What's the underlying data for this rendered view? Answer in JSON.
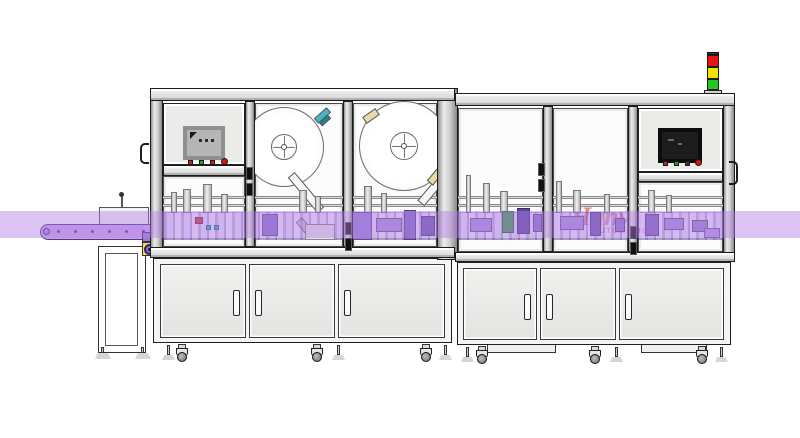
{
  "meta": {
    "width": 800,
    "height": 438,
    "description": "CAD side view of an automatic labeling machine line with infeed conveyor, two enclosed machine frames, two label reels, HMI panels, stack light and base cabinets",
    "background": "#ffffff"
  },
  "band": {
    "y": 211,
    "height": 27,
    "color": "rgba(178,126,232,0.45)"
  },
  "watermark": {
    "parts": [
      {
        "text": "H",
        "color": "#c8281e"
      },
      {
        "text": "a",
        "color": "#f08c1e"
      },
      {
        "text": "nvi",
        "color": "#c8281e"
      }
    ],
    "sub": "AUTOMATION",
    "sub_color": "#c8281e"
  },
  "signal_tower": {
    "base": {
      "x": 704,
      "y": 90,
      "w": 18,
      "h": 5
    },
    "cap": {
      "x": 707,
      "y": 52,
      "w": 12,
      "h": 3
    },
    "segments": [
      {
        "name": "red-light",
        "color": "#e81414",
        "x": 707,
        "y": 55,
        "w": 12,
        "h": 12
      },
      {
        "name": "yellow-light",
        "color": "#f2e400",
        "x": 707,
        "y": 67,
        "w": 12,
        "h": 12
      },
      {
        "name": "green-light",
        "color": "#22c822",
        "x": 707,
        "y": 79,
        "w": 12,
        "h": 11
      }
    ]
  },
  "hmi": {
    "left": {
      "panel": {
        "x": 163,
        "y": 103,
        "w": 82,
        "h": 62
      },
      "screen": {
        "x": 185,
        "y": 128,
        "w": 38,
        "h": 30,
        "bezel": "#8f8f8f",
        "face": "#b5b5b5"
      },
      "buttons": [
        {
          "x": 188,
          "y": 160,
          "shape": "square",
          "color": "#c32420"
        },
        {
          "x": 199,
          "y": 160,
          "shape": "square",
          "color": "#1ea31e"
        },
        {
          "x": 210,
          "y": 160,
          "shape": "square",
          "color": "#c32420"
        },
        {
          "x": 221,
          "y": 158,
          "shape": "round",
          "color": "#e01212"
        }
      ]
    },
    "right": {
      "panel": {
        "x": 638,
        "y": 108,
        "w": 85,
        "h": 64
      },
      "screen": {
        "x": 660,
        "y": 130,
        "w": 40,
        "h": 31,
        "bezel": "#0d0d0d",
        "face": "#1d1d1d"
      },
      "buttons": [
        {
          "x": 663,
          "y": 161,
          "shape": "square",
          "color": "#c32420"
        },
        {
          "x": 674,
          "y": 161,
          "shape": "square",
          "color": "#1ea31e"
        },
        {
          "x": 685,
          "y": 161,
          "shape": "square",
          "color": "#5a2a2a"
        },
        {
          "x": 695,
          "y": 159,
          "shape": "round",
          "color": "#e01212"
        }
      ]
    }
  },
  "frame": {
    "posts": [
      {
        "x": 150,
        "y": 88,
        "w": 13,
        "h": 170
      },
      {
        "x": 245,
        "y": 101,
        "w": 10,
        "h": 146
      },
      {
        "x": 343,
        "y": 101,
        "w": 10,
        "h": 146
      },
      {
        "x": 437,
        "y": 88,
        "w": 21,
        "h": 172
      },
      {
        "x": 543,
        "y": 106,
        "w": 10,
        "h": 146
      },
      {
        "x": 628,
        "y": 106,
        "w": 10,
        "h": 146
      },
      {
        "x": 723,
        "y": 93,
        "w": 12,
        "h": 169
      }
    ],
    "beams": [
      {
        "x": 150,
        "y": 88,
        "w": 305,
        "h": 13
      },
      {
        "x": 455,
        "y": 93,
        "w": 280,
        "h": 13
      },
      {
        "x": 163,
        "y": 165,
        "w": 82,
        "h": 11
      },
      {
        "x": 638,
        "y": 172,
        "w": 85,
        "h": 10
      },
      {
        "x": 150,
        "y": 247,
        "w": 305,
        "h": 11
      },
      {
        "x": 455,
        "y": 252,
        "w": 280,
        "h": 10
      }
    ],
    "rails": [
      {
        "x": 163,
        "y": 196,
        "w": 274,
        "h": 3
      },
      {
        "x": 458,
        "y": 196,
        "w": 265,
        "h": 3
      },
      {
        "x": 163,
        "y": 204,
        "w": 274,
        "h": 3
      },
      {
        "x": 458,
        "y": 204,
        "w": 265,
        "h": 3
      }
    ],
    "hinges": [
      {
        "x": 246,
        "y": 167
      },
      {
        "x": 345,
        "y": 222
      },
      {
        "x": 538,
        "y": 163
      },
      {
        "x": 630,
        "y": 226
      }
    ]
  },
  "glass_panels": [
    {
      "x": 163,
      "y": 176,
      "w": 82,
      "h": 71
    },
    {
      "x": 255,
      "y": 103,
      "w": 88,
      "h": 144
    },
    {
      "x": 353,
      "y": 103,
      "w": 84,
      "h": 144
    },
    {
      "x": 458,
      "y": 108,
      "w": 85,
      "h": 144
    },
    {
      "x": 553,
      "y": 108,
      "w": 75,
      "h": 144
    },
    {
      "x": 638,
      "y": 182,
      "w": 85,
      "h": 70
    }
  ],
  "reels": [
    {
      "cx": 284,
      "cy": 147,
      "r": 40,
      "hub_r": 13
    },
    {
      "cx": 404,
      "cy": 146,
      "r": 45,
      "hub_r": 14
    }
  ],
  "diagonals": [
    {
      "x": 283,
      "y": 188,
      "w": 46,
      "h": 9,
      "rot": 50,
      "color": "#f6f6f6"
    },
    {
      "x": 296,
      "y": 222,
      "w": 16,
      "h": 8,
      "rot": 50,
      "color": "#e8d9a8"
    },
    {
      "x": 314,
      "y": 112,
      "w": 17,
      "h": 7,
      "rot": -42,
      "color": "#47b4c8"
    },
    {
      "x": 319,
      "y": 118,
      "w": 12,
      "h": 5,
      "rot": -42,
      "color": "#2a7f95"
    },
    {
      "x": 363,
      "y": 112,
      "w": 16,
      "h": 8,
      "rot": -35,
      "color": "#e8d9a8"
    },
    {
      "x": 413,
      "y": 182,
      "w": 44,
      "h": 9,
      "rot": -50,
      "color": "#f6f6f6"
    },
    {
      "x": 427,
      "y": 173,
      "w": 16,
      "h": 8,
      "rot": -50,
      "color": "#e8d9a8"
    }
  ],
  "mech_strips": [
    {
      "x": 164,
      "y": 212,
      "w": 273,
      "h": 28
    },
    {
      "x": 458,
      "y": 212,
      "w": 265,
      "h": 28
    }
  ],
  "actuators": [
    {
      "x": 171,
      "y": 192,
      "w": 6,
      "h": 21
    },
    {
      "x": 183,
      "y": 189,
      "w": 8,
      "h": 24
    },
    {
      "x": 203,
      "y": 184,
      "w": 9,
      "h": 29
    },
    {
      "x": 221,
      "y": 194,
      "w": 7,
      "h": 19
    },
    {
      "x": 299,
      "y": 190,
      "w": 8,
      "h": 23
    },
    {
      "x": 315,
      "y": 196,
      "w": 6,
      "h": 17
    },
    {
      "x": 364,
      "y": 186,
      "w": 8,
      "h": 27
    },
    {
      "x": 381,
      "y": 193,
      "w": 6,
      "h": 20
    },
    {
      "x": 466,
      "y": 175,
      "w": 5,
      "h": 38
    },
    {
      "x": 483,
      "y": 183,
      "w": 7,
      "h": 30
    },
    {
      "x": 500,
      "y": 191,
      "w": 8,
      "h": 22
    },
    {
      "x": 556,
      "y": 181,
      "w": 6,
      "h": 32
    },
    {
      "x": 573,
      "y": 190,
      "w": 8,
      "h": 23
    },
    {
      "x": 604,
      "y": 194,
      "w": 6,
      "h": 19
    },
    {
      "x": 648,
      "y": 190,
      "w": 7,
      "h": 23
    },
    {
      "x": 666,
      "y": 195,
      "w": 6,
      "h": 18
    }
  ],
  "accents": [
    {
      "x": 195,
      "y": 217,
      "w": 8,
      "h": 7,
      "color": "#cf3a3a"
    },
    {
      "x": 206,
      "y": 225,
      "w": 5,
      "h": 5,
      "color": "#2fb0b0"
    },
    {
      "x": 214,
      "y": 225,
      "w": 5,
      "h": 5,
      "color": "#2fb0b0"
    },
    {
      "x": 262,
      "y": 214,
      "w": 16,
      "h": 22,
      "color": "#8d74c6"
    },
    {
      "x": 305,
      "y": 224,
      "w": 30,
      "h": 16,
      "color": "#e3e3e0"
    },
    {
      "x": 352,
      "y": 212,
      "w": 20,
      "h": 28,
      "color": "#9a7fd0"
    },
    {
      "x": 376,
      "y": 218,
      "w": 26,
      "h": 14,
      "color": "#a78fd6"
    },
    {
      "x": 404,
      "y": 210,
      "w": 12,
      "h": 30,
      "color": "#8268bd"
    },
    {
      "x": 421,
      "y": 216,
      "w": 14,
      "h": 20,
      "color": "#6e58a8"
    },
    {
      "x": 444,
      "y": 214,
      "w": 10,
      "h": 22,
      "color": "#7d64b5"
    },
    {
      "x": 470,
      "y": 218,
      "w": 22,
      "h": 14,
      "color": "#a78fd6"
    },
    {
      "x": 502,
      "y": 211,
      "w": 12,
      "h": 22,
      "color": "#3f9c4a"
    },
    {
      "x": 517,
      "y": 208,
      "w": 13,
      "h": 26,
      "color": "#5a4797"
    },
    {
      "x": 533,
      "y": 214,
      "w": 9,
      "h": 18,
      "color": "#8d74c6"
    },
    {
      "x": 560,
      "y": 216,
      "w": 24,
      "h": 14,
      "color": "#a78fd6"
    },
    {
      "x": 590,
      "y": 212,
      "w": 11,
      "h": 24,
      "color": "#6e58a8"
    },
    {
      "x": 615,
      "y": 218,
      "w": 10,
      "h": 14,
      "color": "#8d74c6"
    },
    {
      "x": 645,
      "y": 214,
      "w": 14,
      "h": 22,
      "color": "#7d64b5"
    },
    {
      "x": 664,
      "y": 218,
      "w": 20,
      "h": 12,
      "color": "#a78fd6"
    },
    {
      "x": 692,
      "y": 220,
      "w": 16,
      "h": 12,
      "color": "#9a82cd"
    },
    {
      "x": 704,
      "y": 228,
      "w": 16,
      "h": 10,
      "color": "#b49ade"
    }
  ],
  "cabinets": [
    {
      "x": 153,
      "y": 258,
      "w": 299,
      "h": 85
    },
    {
      "x": 457,
      "y": 262,
      "w": 274,
      "h": 83
    }
  ],
  "doors": [
    {
      "x": 160,
      "y": 264,
      "w": 86,
      "h": 74,
      "handle": "right"
    },
    {
      "x": 249,
      "y": 264,
      "w": 86,
      "h": 74,
      "handle": "left"
    },
    {
      "x": 338,
      "y": 264,
      "w": 107,
      "h": 74,
      "handle": "left"
    },
    {
      "x": 463,
      "y": 268,
      "w": 74,
      "h": 72,
      "handle": "right"
    },
    {
      "x": 540,
      "y": 268,
      "w": 76,
      "h": 72,
      "handle": "left"
    },
    {
      "x": 619,
      "y": 268,
      "w": 105,
      "h": 72,
      "handle": "left"
    }
  ],
  "platforms": [
    {
      "x": 487,
      "y": 344,
      "w": 69,
      "h": 9
    },
    {
      "x": 641,
      "y": 344,
      "w": 66,
      "h": 9
    }
  ],
  "supports": [
    {
      "type": "foot",
      "x": 162,
      "y": 345
    },
    {
      "type": "caster",
      "x": 176,
      "y": 344
    },
    {
      "type": "caster",
      "x": 311,
      "y": 344
    },
    {
      "type": "foot",
      "x": 332,
      "y": 345
    },
    {
      "type": "caster",
      "x": 420,
      "y": 344
    },
    {
      "type": "foot",
      "x": 439,
      "y": 345
    },
    {
      "type": "foot",
      "x": 461,
      "y": 347
    },
    {
      "type": "caster",
      "x": 476,
      "y": 346
    },
    {
      "type": "caster",
      "x": 589,
      "y": 346
    },
    {
      "type": "foot",
      "x": 610,
      "y": 347
    },
    {
      "type": "caster",
      "x": 696,
      "y": 346
    },
    {
      "type": "foot",
      "x": 715,
      "y": 347
    }
  ],
  "conveyor": {
    "belt": {
      "x": 40,
      "y": 224,
      "w": 113,
      "h": 16
    },
    "dots": {
      "count": 6,
      "start_x": 57,
      "step": 17,
      "y": 230
    },
    "infeed_box": {
      "x": 99,
      "y": 207,
      "w": 50,
      "h": 18
    },
    "pin": {
      "x": 121,
      "y": 195,
      "w": 2,
      "h": 12
    },
    "gear_square": {
      "x": 142,
      "y": 232,
      "w": 15,
      "h": 10
    },
    "gear_box": {
      "x": 142,
      "y": 242,
      "w": 15,
      "h": 14
    },
    "stand": {
      "x": 98,
      "y": 246,
      "w": 48,
      "h": 107
    },
    "stand_inner": {
      "x": 105,
      "y": 253,
      "w": 33,
      "h": 93
    },
    "feet": [
      {
        "x": 95,
        "y": 352
      },
      {
        "x": 135,
        "y": 352
      }
    ]
  },
  "ext_handles": [
    {
      "x": 140,
      "y": 143,
      "w": 9,
      "h": 21,
      "side": "left"
    },
    {
      "x": 729,
      "y": 161,
      "w": 9,
      "h": 24,
      "side": "right"
    }
  ]
}
